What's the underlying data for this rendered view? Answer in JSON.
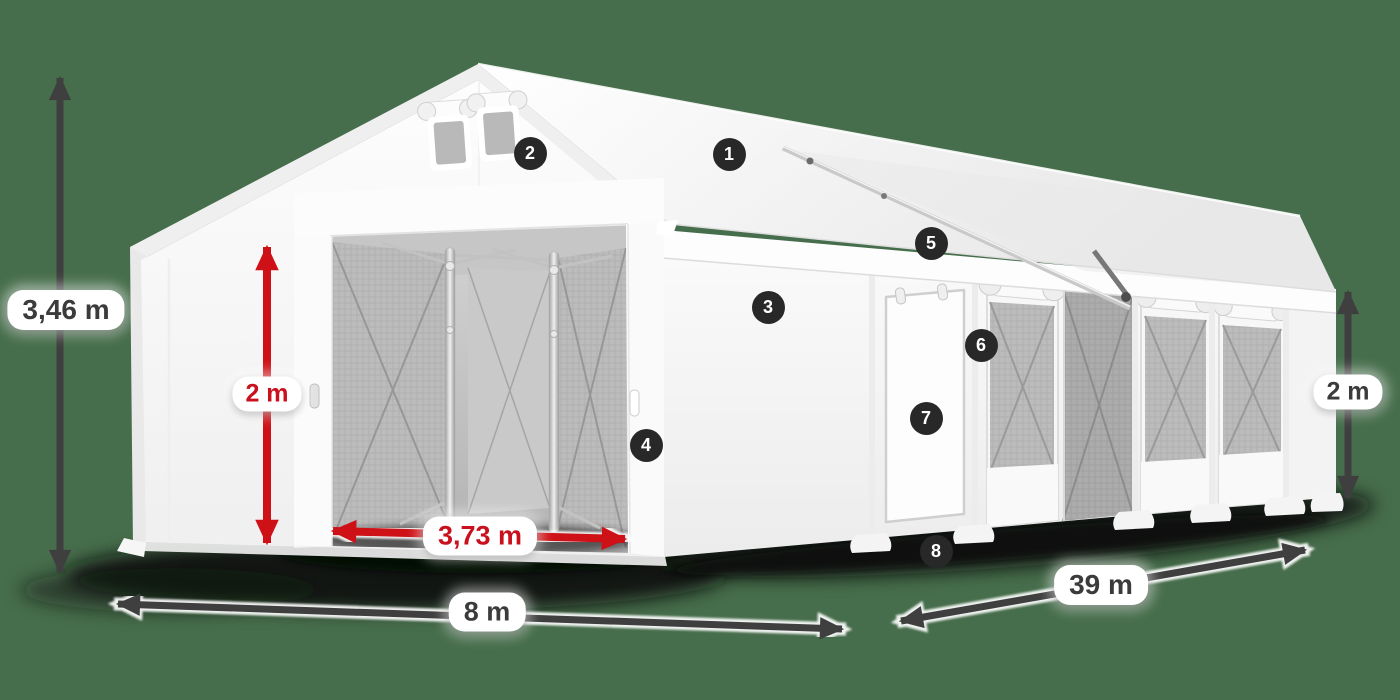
{
  "scene": {
    "subject": "White modular marquee tent - 3D product render with dimension annotations",
    "background_color": "#476e4c"
  },
  "dimension_labels": {
    "total_height": {
      "text": "3,46 m",
      "style": "dark"
    },
    "door_height": {
      "text": "2 m",
      "style": "red"
    },
    "door_width": {
      "text": "3,73 m",
      "style": "red"
    },
    "front_width": {
      "text": "8 m",
      "style": "dark"
    },
    "side_length": {
      "text": "39 m",
      "style": "dark"
    },
    "side_wall_height": {
      "text": "2 m",
      "style": "dark"
    }
  },
  "part_markers": [
    {
      "number": "1"
    },
    {
      "number": "2"
    },
    {
      "number": "3"
    },
    {
      "number": "4"
    },
    {
      "number": "5"
    },
    {
      "number": "6"
    },
    {
      "number": "7"
    },
    {
      "number": "8"
    }
  ],
  "colors": {
    "background": "#476e4c",
    "dark_arrow": "#3f3f3f",
    "red_arrow": "#ce1117",
    "red_text": "#c9101c",
    "dark_text": "#3b3b3b",
    "marker_badge": "#282828",
    "tent": "#ffffff"
  }
}
